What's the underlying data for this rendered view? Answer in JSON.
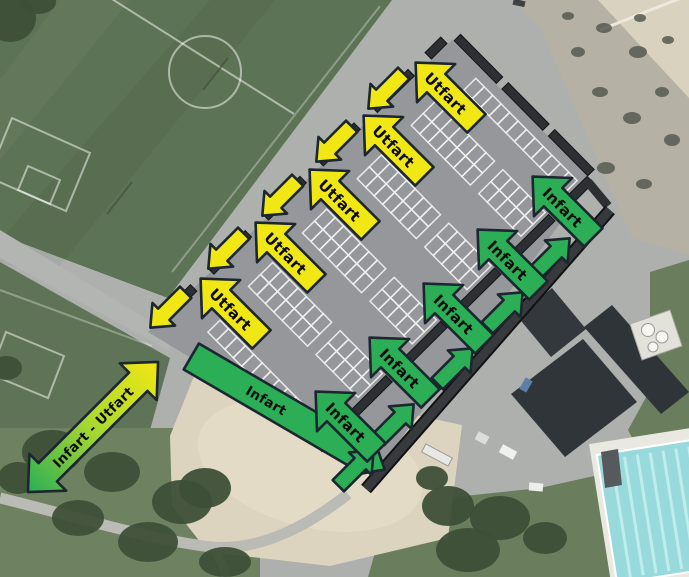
{
  "labels": {
    "exit": "Utfart",
    "entry": "Infart",
    "entry_exit": "Infart - Utfart"
  },
  "colors": {
    "exit_arrow": "#F1E714",
    "entry_arrow": "#2BAE55",
    "arrow_outline": "#1B2630",
    "arrow_text": "#0D0D0D"
  },
  "annotations": {
    "exit_arrows": 5,
    "exit_flow_arrows": 5,
    "entry_arrows": 5,
    "entry_flow_arrows": 5,
    "entry_road_arrows": 1,
    "two_way_arrows": 1
  }
}
